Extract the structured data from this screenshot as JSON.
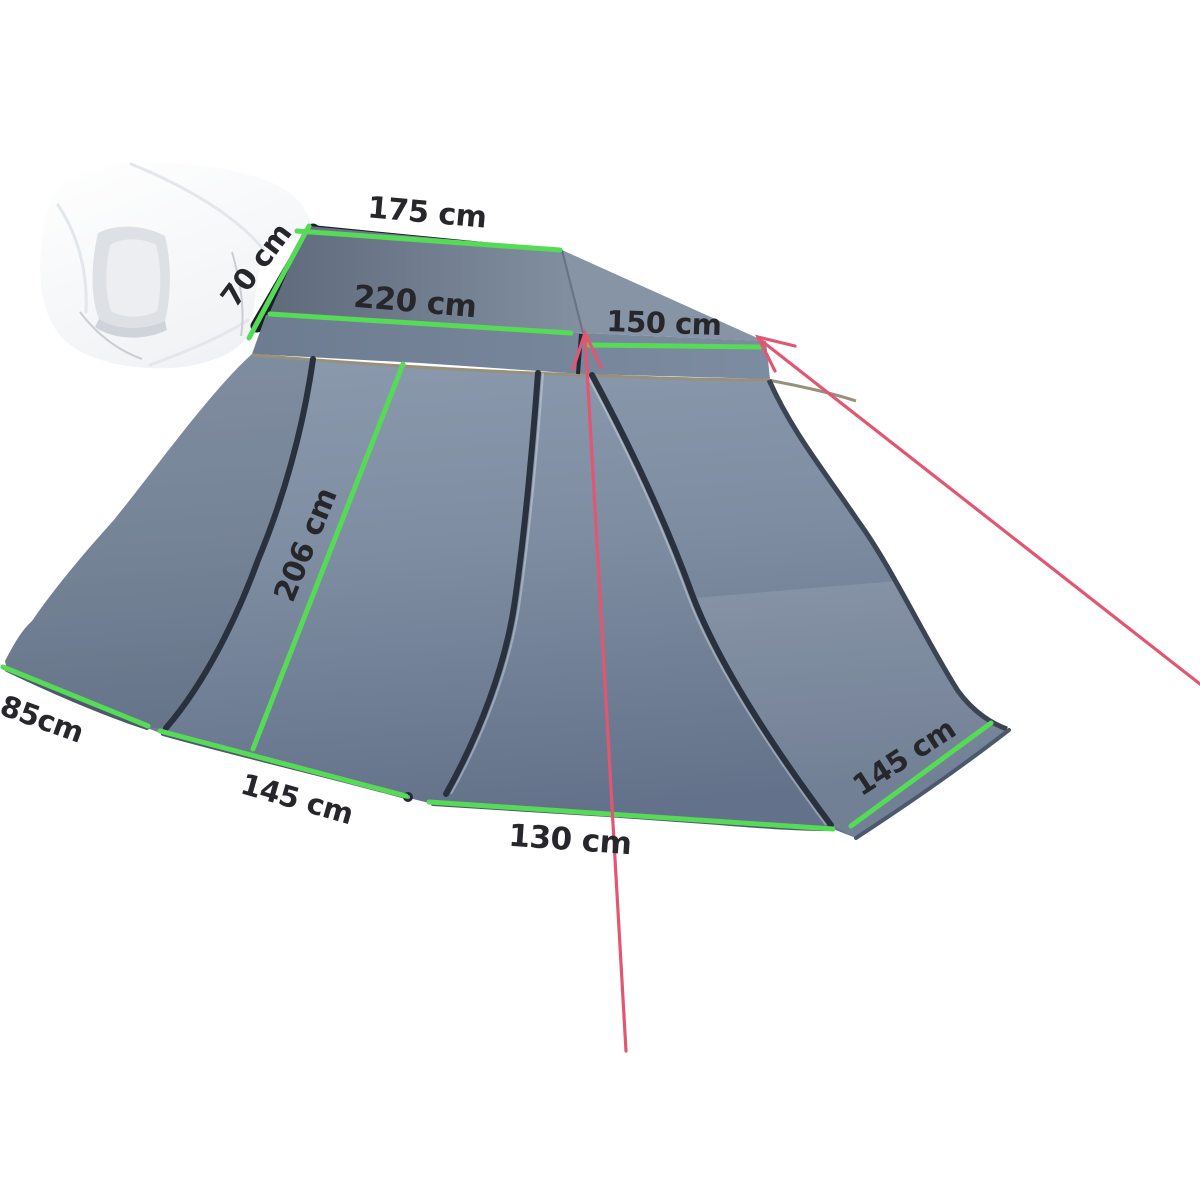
{
  "figure": {
    "alt": "Dimension diagram of a grey vehicle rooftop-tent awning skirt attached under a white folded rooftop tent, with green measurement lines and red guy ropes"
  },
  "colors": {
    "dimension_line": "#55db55",
    "guy_line": "#e25672",
    "label_text": "#26262b",
    "fabric_main": "#7d8ca0",
    "fabric_cover": "#f4f6f8"
  },
  "dimension_labels": [
    {
      "id": "top-width",
      "text": "175 cm"
    },
    {
      "id": "attachment-height",
      "text": "70 cm"
    },
    {
      "id": "upper-front-width",
      "text": "220 cm"
    },
    {
      "id": "upper-side-width",
      "text": "150 cm"
    },
    {
      "id": "wall-slant-height",
      "text": "206 cm"
    },
    {
      "id": "rear-left-width",
      "text": "85cm"
    },
    {
      "id": "lower-left-width",
      "text": "145 cm"
    },
    {
      "id": "door-width",
      "text": "130 cm"
    },
    {
      "id": "right-width",
      "text": "145 cm"
    }
  ]
}
